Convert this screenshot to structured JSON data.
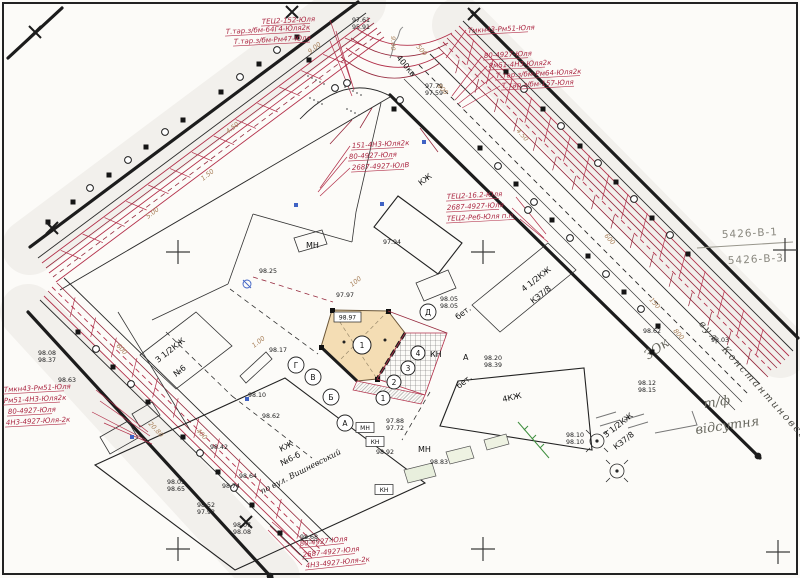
{
  "sheet": {
    "grid_ref_top": "5426-В-1",
    "grid_ref_bottom": "5426-В-3",
    "street_label": "вул. Константиновська",
    "notes": {
      "zok": "ЗОк",
      "tf": "т/ф",
      "absent": "відсутня"
    }
  },
  "subject": {
    "number": "1",
    "elevation_box": "98.97"
  },
  "colors": {
    "utility_red": "#b3314b",
    "annotation_red": "#ab2742",
    "subject_fill": "#f4ddb4",
    "distance_tan": "#a8805a",
    "blue_mark": "#3f62c4",
    "green_mark": "#3f8f3f",
    "pencil_gray": "#68685f"
  },
  "red_annotations": [
    {
      "t": "ТЕЦ2-152-Юля",
      "x": 262,
      "y": 24,
      "r": -3
    },
    {
      "t": "Т.тар.з/бм-64Г4-Юля2к",
      "x": 226,
      "y": 34,
      "r": -3
    },
    {
      "t": "Т.тар.з/бм-Рм47-Юля",
      "x": 234,
      "y": 44,
      "r": -3
    },
    {
      "t": "Тмкн43-Рм51-Юля",
      "x": 468,
      "y": 33,
      "r": -3
    },
    {
      "t": "80-4927-Юля",
      "x": 484,
      "y": 58,
      "r": -3
    },
    {
      "t": "Рм51-4Н3-Юля2к",
      "x": 489,
      "y": 68,
      "r": -3
    },
    {
      "t": "Т.тар.з/бм-Рм64-Юля2к",
      "x": 496,
      "y": 78,
      "r": -3
    },
    {
      "t": "Т.тар.з/бм-157-Юля",
      "x": 502,
      "y": 88,
      "r": -3
    },
    {
      "t": "151-4Н3-Юля2к",
      "x": 352,
      "y": 148,
      "r": -3
    },
    {
      "t": "80-4927-Юля",
      "x": 349,
      "y": 159,
      "r": -3
    },
    {
      "t": "2687-4927-ЮлВ",
      "x": 352,
      "y": 170,
      "r": -3
    },
    {
      "t": "ТЕЦ2-16.2-Юля",
      "x": 447,
      "y": 199,
      "r": -3
    },
    {
      "t": "2687-4927-Юля",
      "x": 447,
      "y": 210,
      "r": -3
    },
    {
      "t": "ТЕЦ2-Реб-Юля п.п.",
      "x": 447,
      "y": 221,
      "r": -3
    },
    {
      "t": "Тмкн43-Рм51-Юля",
      "x": 4,
      "y": 392,
      "r": -3
    },
    {
      "t": "Рм51-4Н3-Юля2к",
      "x": 4,
      "y": 403,
      "r": -3
    },
    {
      "t": "80-4927-Юля",
      "x": 8,
      "y": 414,
      "r": -3
    },
    {
      "t": "4Н3-4927-Юля-2к",
      "x": 6,
      "y": 425,
      "r": -3
    },
    {
      "t": "80-4927-Юля",
      "x": 300,
      "y": 546,
      "r": -6
    },
    {
      "t": "2687-4927-Юля",
      "x": 303,
      "y": 557,
      "r": -6
    },
    {
      "t": "4Н3-4927-Юля-2к",
      "x": 306,
      "y": 568,
      "r": -6
    }
  ],
  "black_labels": [
    {
      "t": "КЖ",
      "x": 421,
      "y": 186,
      "r": -38,
      "s": 9
    },
    {
      "t": "МН",
      "x": 306,
      "y": 248,
      "r": 0,
      "s": 8
    },
    {
      "t": "бет.",
      "x": 458,
      "y": 320,
      "r": -38,
      "s": 7
    },
    {
      "t": "бет.",
      "x": 459,
      "y": 389,
      "r": -38,
      "s": 7
    },
    {
      "t": "А",
      "x": 463,
      "y": 360,
      "r": 0,
      "s": 8
    },
    {
      "t": "КН",
      "x": 430,
      "y": 357,
      "r": 0,
      "s": 7
    },
    {
      "t": "4КЖ",
      "x": 503,
      "y": 402,
      "r": -12,
      "s": 9
    },
    {
      "t": "4 1/2КЖ",
      "x": 524,
      "y": 292,
      "r": -38,
      "s": 8
    },
    {
      "t": "КЗ7/8",
      "x": 533,
      "y": 304,
      "r": -38,
      "s": 8
    },
    {
      "t": "З 1/2КЖ",
      "x": 606,
      "y": 438,
      "r": -38,
      "s": 8
    },
    {
      "t": "КЗ7/8",
      "x": 616,
      "y": 450,
      "r": -38,
      "s": 8
    },
    {
      "t": "З 1/2КЖ",
      "x": 158,
      "y": 363,
      "r": -38,
      "s": 8
    },
    {
      "t": "№6",
      "x": 176,
      "y": 377,
      "r": -38,
      "s": 8
    },
    {
      "t": "КЖ",
      "x": 281,
      "y": 452,
      "r": -27,
      "s": 9
    },
    {
      "t": "№6-б",
      "x": 282,
      "y": 466,
      "r": -27,
      "s": 9
    },
    {
      "t": "по вул. Вишневський",
      "x": 262,
      "y": 494,
      "r": -27,
      "s": 8.5,
      "serif": 1
    },
    {
      "t": "МН",
      "x": 418,
      "y": 452,
      "r": 0,
      "s": 8
    },
    {
      "t": "400кв",
      "x": 396,
      "y": 58,
      "r": 50,
      "s": 7,
      "c": "#5b77c9"
    }
  ],
  "boxed_labels": [
    {
      "t": "МН",
      "x": 365,
      "y": 430
    },
    {
      "t": "КН",
      "x": 375,
      "y": 444
    },
    {
      "t": "КН",
      "x": 384,
      "y": 492
    }
  ],
  "circled_letters": [
    {
      "t": "А",
      "x": 345,
      "y": 423
    },
    {
      "t": "Б",
      "x": 331,
      "y": 397
    },
    {
      "t": "В",
      "x": 313,
      "y": 377
    },
    {
      "t": "Г",
      "x": 296,
      "y": 365
    },
    {
      "t": "Д",
      "x": 428,
      "y": 312
    }
  ],
  "circled_numbers": [
    {
      "t": "1",
      "x": 362,
      "y": 345,
      "rad": 9
    },
    {
      "t": "1",
      "x": 383,
      "y": 398,
      "rad": 7
    },
    {
      "t": "2",
      "x": 394,
      "y": 382,
      "rad": 7
    },
    {
      "t": "3",
      "x": 408,
      "y": 368,
      "rad": 7
    },
    {
      "t": "4",
      "x": 418,
      "y": 353,
      "rad": 7
    }
  ],
  "elevations": [
    {
      "t": "97.61",
      "x": 352,
      "y": 22
    },
    {
      "t": "95.91",
      "x": 352,
      "y": 29
    },
    {
      "t": "97.79",
      "x": 425,
      "y": 88
    },
    {
      "t": "97.59",
      "x": 425,
      "y": 95
    },
    {
      "t": "97.94",
      "x": 383,
      "y": 244
    },
    {
      "t": "98.25",
      "x": 259,
      "y": 273
    },
    {
      "t": "97.97",
      "x": 336,
      "y": 297
    },
    {
      "t": "98.05",
      "x": 440,
      "y": 301
    },
    {
      "t": "98.05",
      "x": 440,
      "y": 308
    },
    {
      "t": "98.17",
      "x": 269,
      "y": 352
    },
    {
      "t": "98.10",
      "x": 248,
      "y": 397
    },
    {
      "t": "98.62",
      "x": 262,
      "y": 418
    },
    {
      "t": "98.42",
      "x": 210,
      "y": 449
    },
    {
      "t": "98.64",
      "x": 239,
      "y": 478
    },
    {
      "t": "98.74",
      "x": 222,
      "y": 488
    },
    {
      "t": "98.05",
      "x": 167,
      "y": 484
    },
    {
      "t": "98.65",
      "x": 167,
      "y": 491
    },
    {
      "t": "98.52",
      "x": 197,
      "y": 507
    },
    {
      "t": "97.92",
      "x": 197,
      "y": 514
    },
    {
      "t": "98.07",
      "x": 233,
      "y": 527
    },
    {
      "t": "98.08",
      "x": 233,
      "y": 534
    },
    {
      "t": "98.92",
      "x": 376,
      "y": 454
    },
    {
      "t": "97.88",
      "x": 386,
      "y": 423
    },
    {
      "t": "97.72",
      "x": 386,
      "y": 430
    },
    {
      "t": "98.83",
      "x": 430,
      "y": 464
    },
    {
      "t": "98.68",
      "x": 300,
      "y": 539,
      "u": 1
    },
    {
      "t": "98.20",
      "x": 484,
      "y": 360
    },
    {
      "t": "98.39",
      "x": 484,
      "y": 367
    },
    {
      "t": "98.10",
      "x": 566,
      "y": 437
    },
    {
      "t": "98.10",
      "x": 566,
      "y": 444
    },
    {
      "t": "98.08",
      "x": 38,
      "y": 355
    },
    {
      "t": "98.37",
      "x": 38,
      "y": 362
    },
    {
      "t": "98.63",
      "x": 58,
      "y": 382
    },
    {
      "t": "98.62",
      "x": 643,
      "y": 333
    },
    {
      "t": "98.03",
      "x": 711,
      "y": 342
    },
    {
      "t": "98.12",
      "x": 638,
      "y": 385
    },
    {
      "t": "98.15",
      "x": 638,
      "y": 392
    }
  ],
  "distance_marks": [
    {
      "t": "4.50",
      "x": 228,
      "y": 134,
      "r": -38
    },
    {
      "t": "1.50",
      "x": 203,
      "y": 181,
      "r": -38
    },
    {
      "t": "5.00",
      "x": 148,
      "y": 219,
      "r": -38
    },
    {
      "t": "9.00",
      "x": 310,
      "y": 54,
      "r": -38
    },
    {
      "t": "9.00",
      "x": 391,
      "y": 36,
      "r": 90
    },
    {
      "t": "1.00",
      "x": 254,
      "y": 348,
      "r": -38
    },
    {
      "t": "100",
      "x": 352,
      "y": 287,
      "r": -38
    },
    {
      "t": "500",
      "x": 416,
      "y": 47,
      "r": 48
    },
    {
      "t": "800",
      "x": 437,
      "y": 86,
      "r": 48
    },
    {
      "t": "4.50",
      "x": 516,
      "y": 131,
      "r": 48
    },
    {
      "t": "600",
      "x": 604,
      "y": 236,
      "r": 48
    },
    {
      "t": "150",
      "x": 649,
      "y": 300,
      "r": 48
    },
    {
      "t": "800",
      "x": 673,
      "y": 331,
      "r": 48
    },
    {
      "t": "600",
      "x": 116,
      "y": 346,
      "r": 47
    },
    {
      "t": "400",
      "x": 196,
      "y": 431,
      "r": 47
    },
    {
      "t": "20.80",
      "x": 148,
      "y": 424,
      "r": 47,
      "c": "#3f8f3f"
    }
  ]
}
